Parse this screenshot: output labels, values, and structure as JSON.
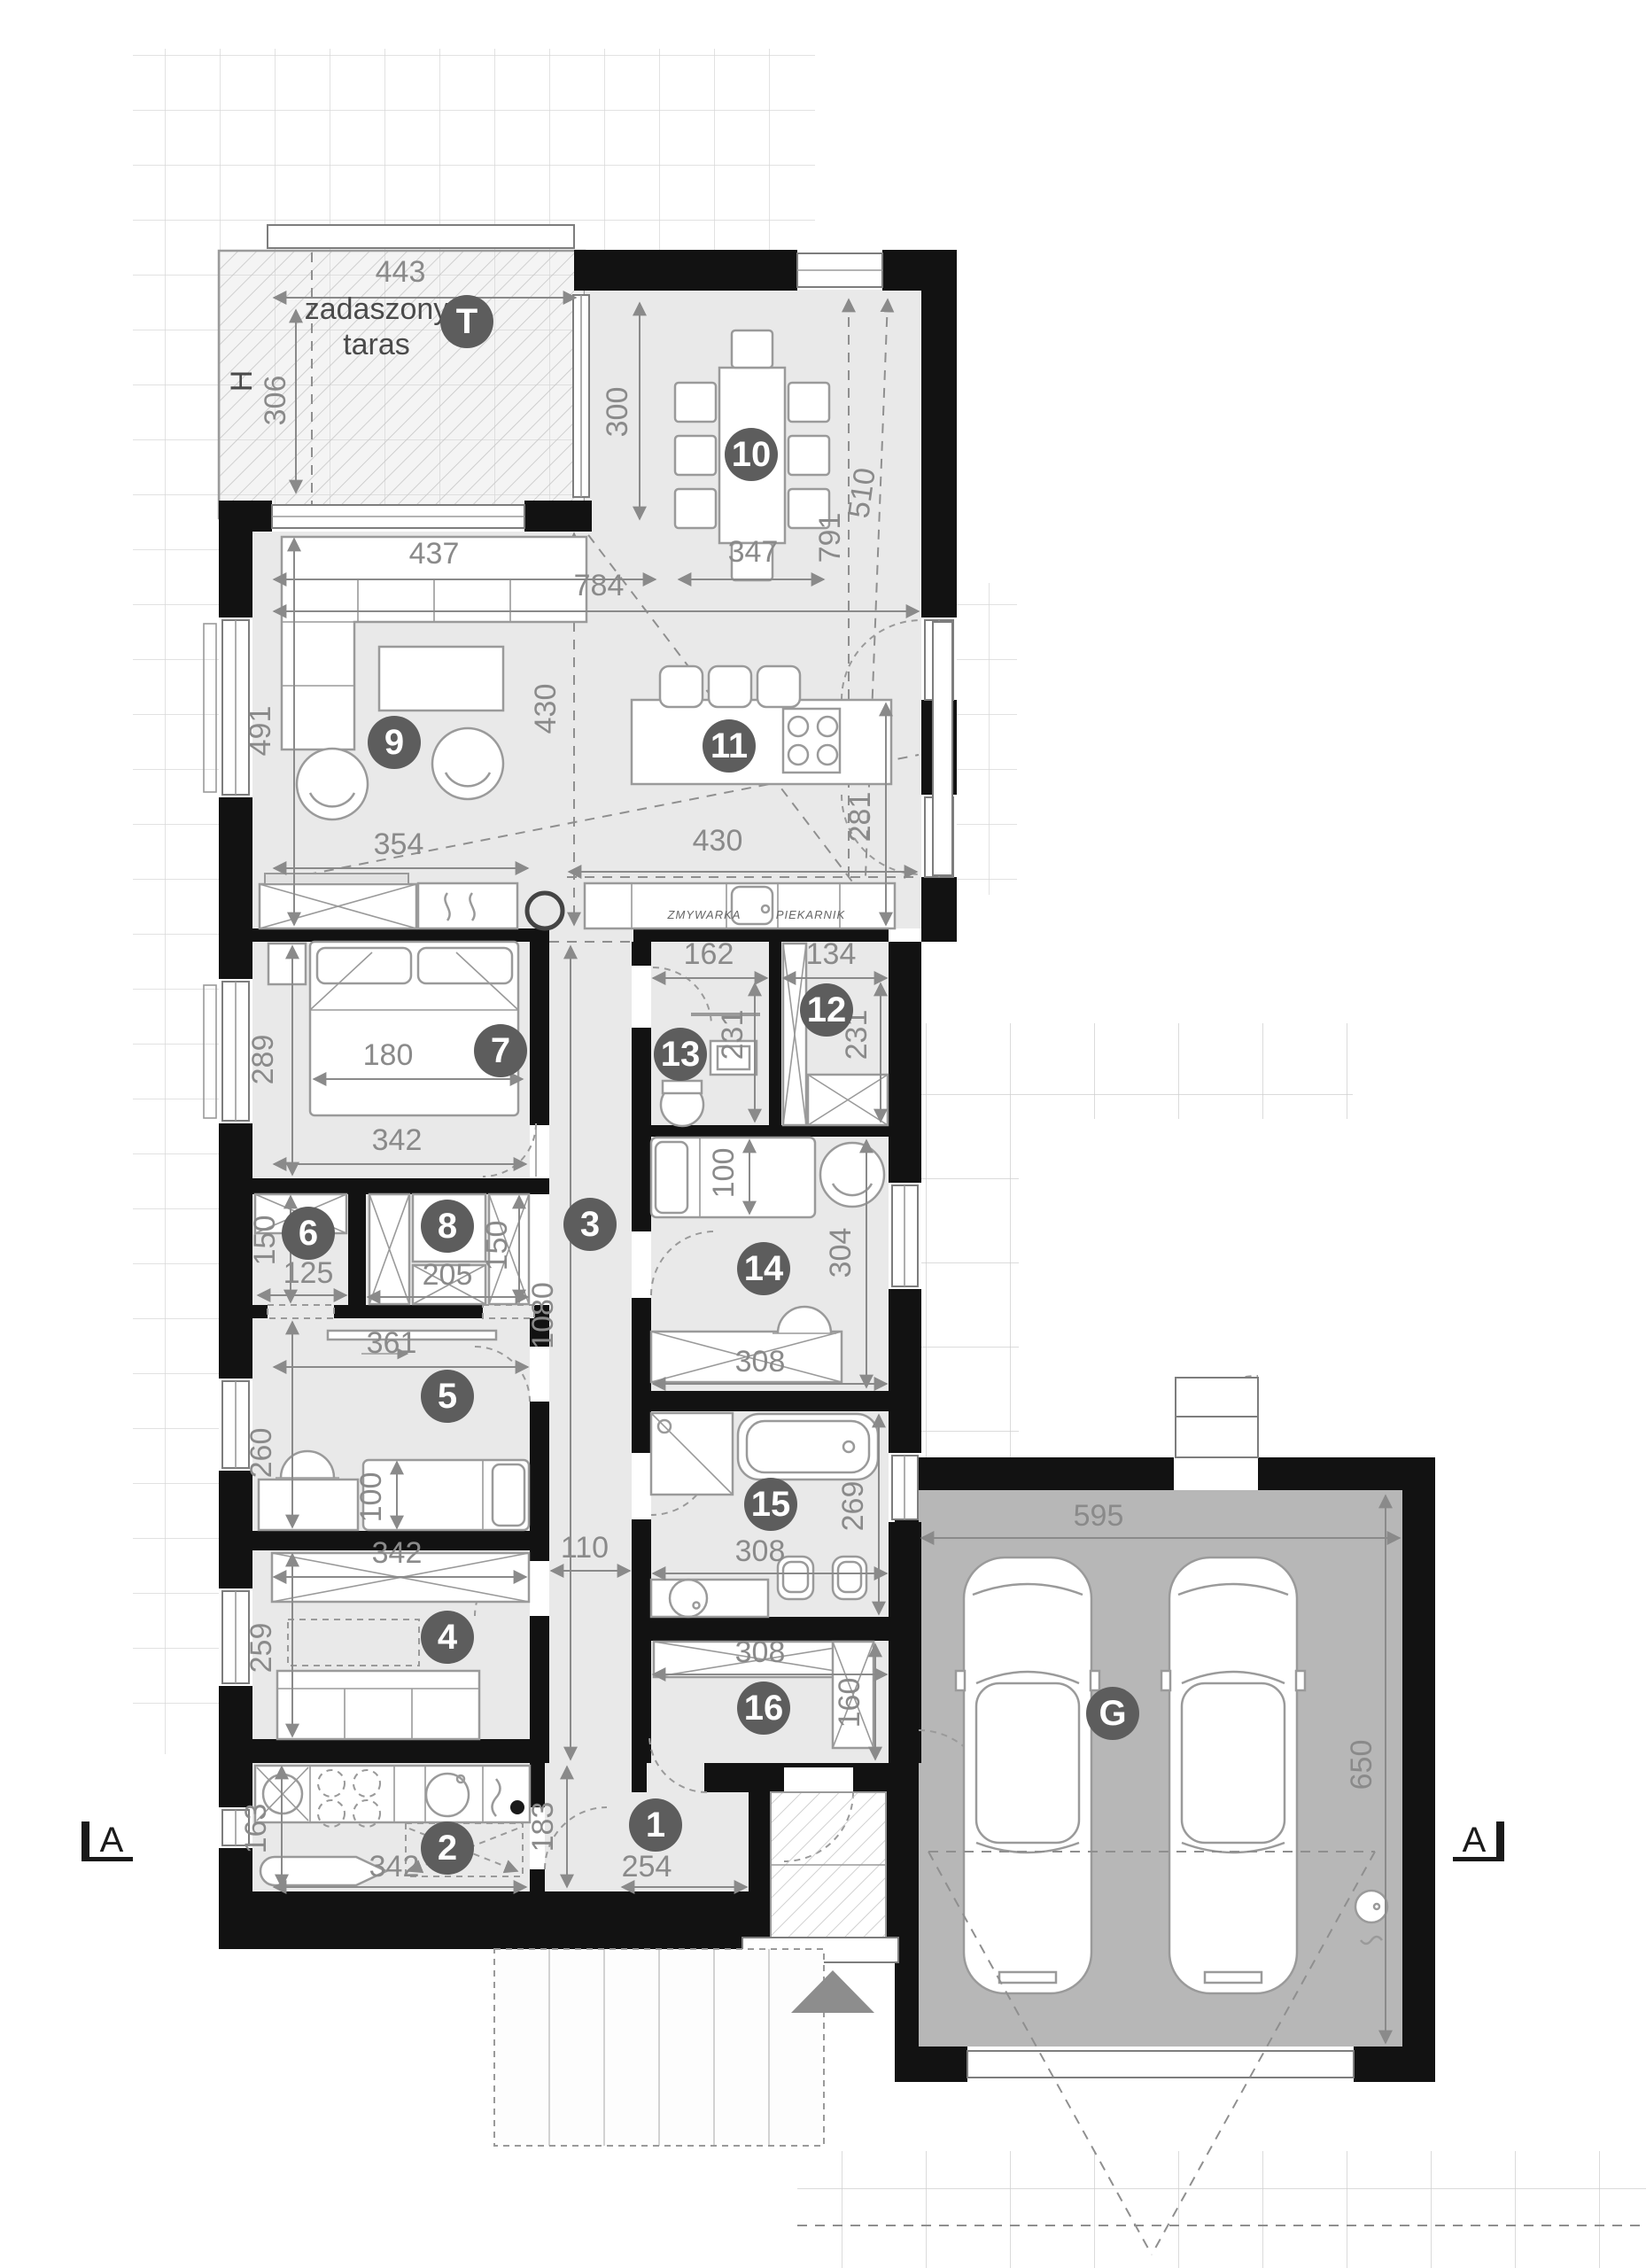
{
  "colors": {
    "wall": "#121212",
    "room_fill": "#e9e9e9",
    "terrace_fill": "#f4f4f4",
    "garage_floor": "#b7b7b7",
    "badge": "#5d5d5d",
    "dim_text": "#8a8a8a"
  },
  "rooms": {
    "t": "T",
    "g": "G",
    "n1": "1",
    "n2": "2",
    "n3": "3",
    "n4": "4",
    "n5": "5",
    "n6": "6",
    "n7": "7",
    "n8": "8",
    "n9": "9",
    "n10": "10",
    "n11": "11",
    "n12": "12",
    "n13": "13",
    "n14": "14",
    "n15": "15",
    "n16": "16"
  },
  "labels": {
    "terrace_line1": "zadaszony",
    "terrace_line2": "taras",
    "h_marker": "H",
    "dishwasher": "ZMYWARKA",
    "oven": "PIEKARNIK",
    "section_left": "A",
    "section_right": "A"
  },
  "dims": {
    "terrace_w": "443",
    "terrace_h": "306",
    "dining_h": "300",
    "dining_table_w": "347",
    "diag_791": "791",
    "diag_510": "510",
    "open_w": "784",
    "sofa_w": "437",
    "living_h": "491",
    "living_e_h": "430",
    "living_s_w": "354",
    "kitchen_w": "430",
    "kitchen_h": "281",
    "wc_w": "162",
    "pantry_w": "134",
    "wc_h": "231",
    "pantry_h": "231",
    "bed7_h": "289",
    "bed7_bed": "180",
    "bed7_w": "342",
    "closet6_h": "150",
    "closet6_w": "125",
    "closet8_h": "150",
    "closet8_w": "205",
    "corridor_len": "1080",
    "corridor_w": "110",
    "bed14_bed": "100",
    "room14_h": "304",
    "room14_w": "308",
    "room5_w": "361",
    "room5_h": "260",
    "room5_bed": "100",
    "room4_wardrobe": "342",
    "room4_h": "259",
    "bath_w": "308",
    "bath_h": "269",
    "room16_w": "308",
    "room16_h": "160",
    "room2_h": "163",
    "room2_w": "342",
    "hall_h": "183",
    "hall_w": "254",
    "garage_w": "595",
    "garage_h": "650"
  }
}
